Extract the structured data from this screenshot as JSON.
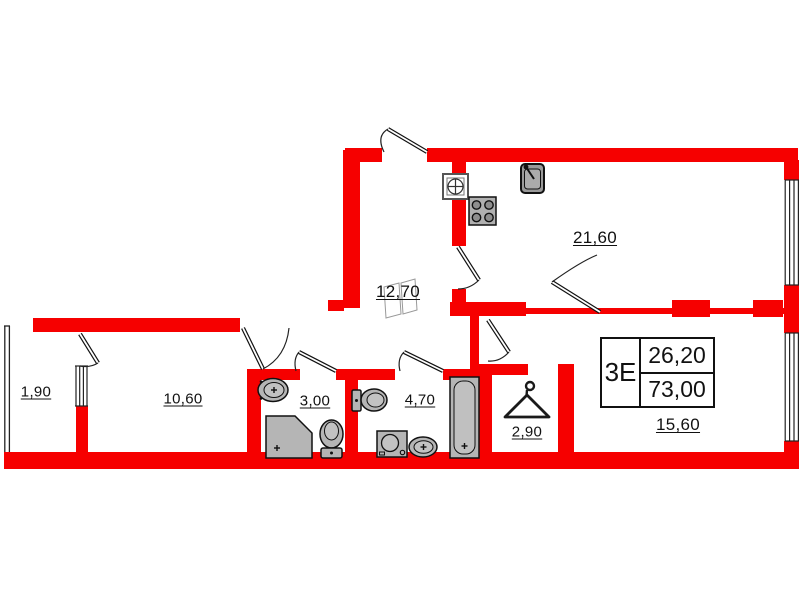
{
  "plan": {
    "info_box": {
      "unit_label": "3Е",
      "value_top": "26,20",
      "value_bottom": "73,00"
    },
    "rooms": {
      "balcony": "1,90",
      "bedroom": "10,60",
      "bathroom_small": "3,00",
      "bathroom": "4,70",
      "wardrobe": "2,90",
      "hallway": "12,70",
      "living_kitchen": "21,60",
      "bottom_room": "15,60"
    },
    "colors": {
      "wall": "#f60000",
      "fixture_fill": "#b5b5b5",
      "line": "#111111"
    }
  }
}
